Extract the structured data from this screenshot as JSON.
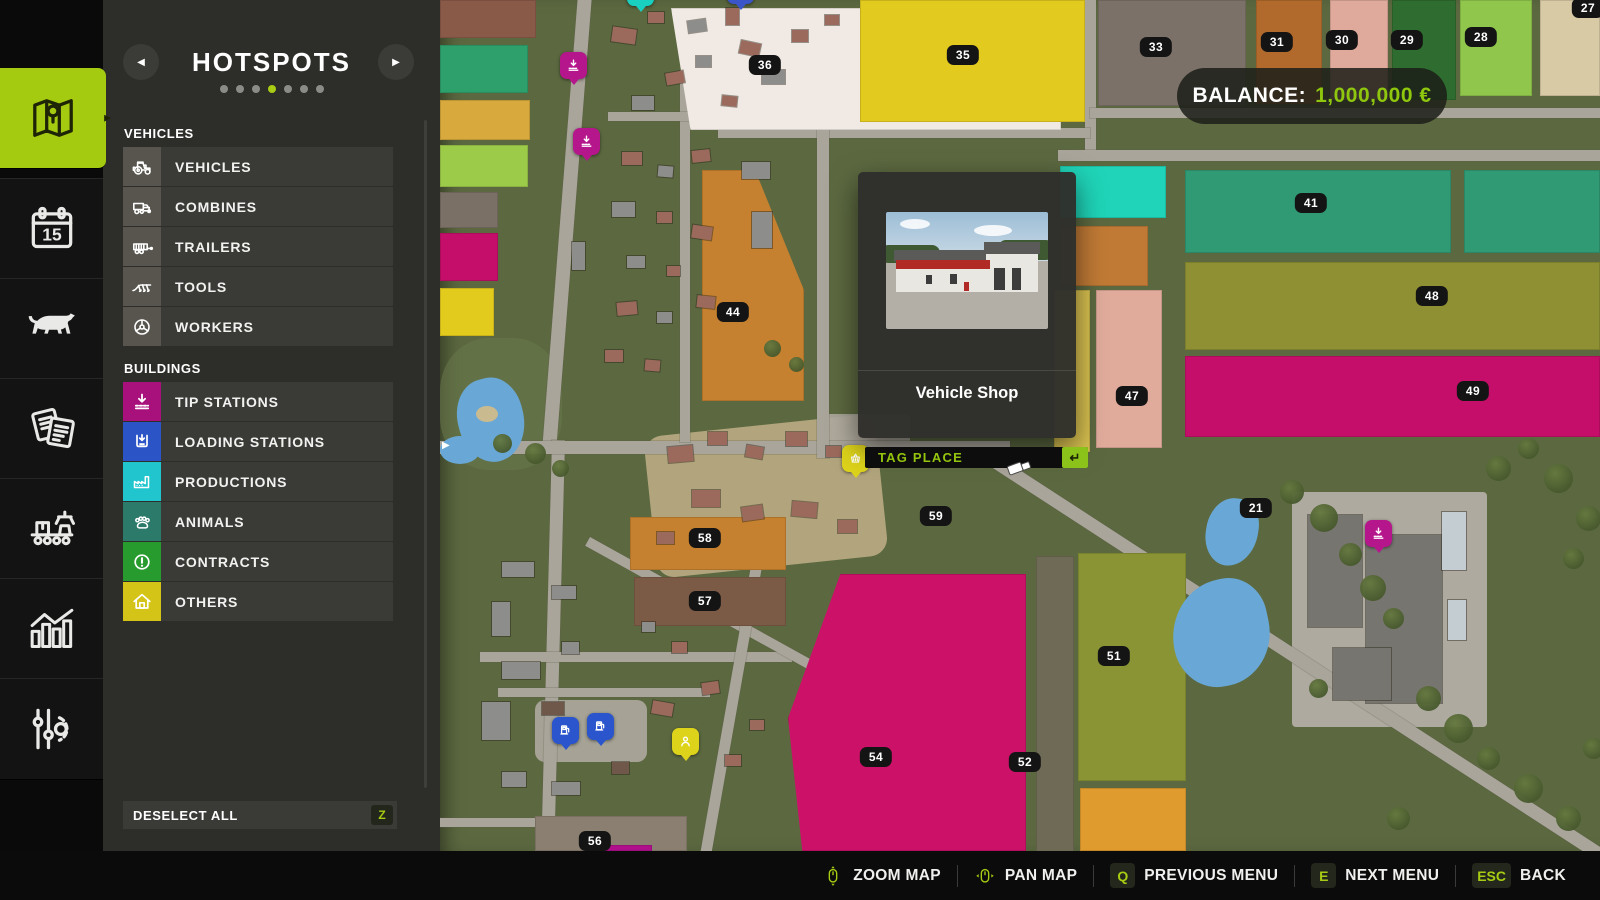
{
  "accent_color": "#a7cc13",
  "sidebar": {
    "tabs": [
      {
        "name": "map",
        "icon": "map-icon",
        "active": true
      },
      {
        "name": "calendar",
        "icon": "calendar-icon",
        "active": false
      },
      {
        "name": "animals",
        "icon": "cow-icon",
        "active": false
      },
      {
        "name": "contracts",
        "icon": "papers-icon",
        "active": false
      },
      {
        "name": "production",
        "icon": "production-icon",
        "active": false
      },
      {
        "name": "statistics",
        "icon": "statistics-icon",
        "active": false
      },
      {
        "name": "settings",
        "icon": "settings-icon",
        "active": false
      }
    ]
  },
  "panel": {
    "title": "HOTSPOTS",
    "dots": {
      "count": 7,
      "active_index": 3
    },
    "sections": [
      {
        "label": "VEHICLES",
        "items": [
          {
            "label": "VEHICLES",
            "icon": "tractor-icon",
            "icon_bg": "#57554e"
          },
          {
            "label": "COMBINES",
            "icon": "combine-icon",
            "icon_bg": "#57554e"
          },
          {
            "label": "TRAILERS",
            "icon": "trailer-icon",
            "icon_bg": "#57554e"
          },
          {
            "label": "TOOLS",
            "icon": "plow-icon",
            "icon_bg": "#57554e"
          },
          {
            "label": "WORKERS",
            "icon": "steering-wheel-icon",
            "icon_bg": "#57554e"
          }
        ]
      },
      {
        "label": "BUILDINGS",
        "items": [
          {
            "label": "TIP STATIONS",
            "icon": "tip-station-icon",
            "icon_bg": "#a8117c"
          },
          {
            "label": "LOADING STATIONS",
            "icon": "loading-station-icon",
            "icon_bg": "#2b54c6"
          },
          {
            "label": "PRODUCTIONS",
            "icon": "factory-icon",
            "icon_bg": "#21c5ce"
          },
          {
            "label": "ANIMALS",
            "icon": "paw-icon",
            "icon_bg": "#2b7a6a"
          },
          {
            "label": "CONTRACTS",
            "icon": "exclamation-icon",
            "icon_bg": "#289b2f"
          },
          {
            "label": "OTHERS",
            "icon": "house-icon",
            "icon_bg": "#d4c417"
          }
        ]
      }
    ],
    "deselect_all": {
      "label": "DESELECT ALL",
      "key": "Z"
    }
  },
  "hud": {
    "balance": {
      "label": "BALANCE:",
      "value": "1,000,000 €",
      "value_color": "#8fc60e"
    },
    "popup": {
      "title": "Vehicle Shop"
    },
    "tag_place": {
      "label": "TAG PLACE",
      "key_glyph": "↵"
    },
    "bottom_bar": [
      {
        "icon": "mouse-zoom-icon",
        "label": "ZOOM MAP"
      },
      {
        "icon": "mouse-pan-icon",
        "label": "PAN MAP"
      },
      {
        "key": "Q",
        "label": "PREVIOUS MENU"
      },
      {
        "key": "E",
        "label": "NEXT MENU"
      },
      {
        "key": "ESC",
        "label": "BACK"
      }
    ]
  },
  "map": {
    "fields": [
      {
        "rect": {
          "x": 231,
          "y": 8,
          "w": 390,
          "h": 122
        },
        "color": "#f1eae4",
        "clip": "polygon(0 0,100% 0,100% 100%,5% 100%)",
        "label": {
          "text": "36",
          "x": 325,
          "y": 65
        }
      },
      {
        "rect": {
          "x": 420,
          "y": 0,
          "w": 225,
          "h": 122
        },
        "color": "#e3ca1e",
        "label": {
          "text": "35",
          "x": 523,
          "y": 55
        }
      },
      {
        "rect": {
          "x": 658,
          "y": 0,
          "w": 148,
          "h": 106
        },
        "color": "#7b7168",
        "label": {
          "text": "33",
          "x": 716,
          "y": 47
        }
      },
      {
        "rect": {
          "x": 816,
          "y": 0,
          "w": 66,
          "h": 104
        },
        "color": "#b16a2c",
        "label": {
          "text": "31",
          "x": 837,
          "y": 42
        }
      },
      {
        "rect": {
          "x": 890,
          "y": 0,
          "w": 58,
          "h": 100
        },
        "color": "#dfa99b",
        "label": {
          "text": "30",
          "x": 902,
          "y": 40
        }
      },
      {
        "rect": {
          "x": 952,
          "y": 0,
          "w": 64,
          "h": 100
        },
        "color": "#2f6c2f",
        "label": {
          "text": "29",
          "x": 967,
          "y": 40
        }
      },
      {
        "rect": {
          "x": 1020,
          "y": 0,
          "w": 72,
          "h": 96
        },
        "color": "#90c64c",
        "label": {
          "text": "28",
          "x": 1041,
          "y": 37
        }
      },
      {
        "rect": {
          "x": 1100,
          "y": 0,
          "w": 60,
          "h": 96
        },
        "color": "#d9caa6",
        "label": {
          "text": "27",
          "x": 1148,
          "y": 8
        }
      },
      {
        "rect": {
          "x": 620,
          "y": 166,
          "w": 106,
          "h": 52
        },
        "color": "#1fd4b8"
      },
      {
        "rect": {
          "x": 745,
          "y": 170,
          "w": 266,
          "h": 83
        },
        "color": "#2f9a74",
        "label": {
          "text": "41",
          "x": 871,
          "y": 203
        }
      },
      {
        "rect": {
          "x": 1024,
          "y": 170,
          "w": 136,
          "h": 83
        },
        "color": "#2f9a74"
      },
      {
        "rect": {
          "x": 620,
          "y": 226,
          "w": 88,
          "h": 60
        },
        "color": "#c07a35"
      },
      {
        "rect": {
          "x": 745,
          "y": 262,
          "w": 415,
          "h": 88
        },
        "color": "#8f9033",
        "label": {
          "text": "48",
          "x": 992,
          "y": 296
        }
      },
      {
        "rect": {
          "x": 745,
          "y": 356,
          "w": 415,
          "h": 81
        },
        "color": "#c50e69",
        "label": {
          "text": "49",
          "x": 1033,
          "y": 391
        }
      },
      {
        "rect": {
          "x": 656,
          "y": 290,
          "w": 66,
          "h": 158
        },
        "color": "#e0ab9b",
        "label": {
          "text": "47",
          "x": 692,
          "y": 396
        }
      },
      {
        "rect": {
          "x": 614,
          "y": 290,
          "w": 36,
          "h": 162
        },
        "color": "#d9c150"
      },
      {
        "rect": {
          "x": 638,
          "y": 553,
          "w": 108,
          "h": 228
        },
        "color": "#8a9434",
        "label": {
          "text": "51",
          "x": 674,
          "y": 656
        }
      },
      {
        "rect": {
          "x": 596,
          "y": 556,
          "w": 38,
          "h": 296
        },
        "color": "#6e6a55",
        "label": {
          "text": "52",
          "x": 585,
          "y": 762
        }
      },
      {
        "rect": {
          "x": 640,
          "y": 788,
          "w": 106,
          "h": 63
        },
        "color": "#e09b2f"
      },
      {
        "rect": {
          "x": 348,
          "y": 574,
          "w": 238,
          "h": 277
        },
        "color": "#cc1168",
        "clip": "polygon(22% 0,100% 0,100% 100%,6% 100%,0 52%)",
        "label": {
          "text": "54",
          "x": 436,
          "y": 757
        }
      },
      {
        "rect": {
          "x": 190,
          "y": 517,
          "w": 156,
          "h": 53
        },
        "color": "#c5812f",
        "label": {
          "text": "58",
          "x": 265,
          "y": 538
        }
      },
      {
        "rect": {
          "x": 194,
          "y": 577,
          "w": 152,
          "h": 49
        },
        "color": "#7b5b45",
        "label": {
          "text": "57",
          "x": 265,
          "y": 601
        }
      },
      {
        "label": {
          "text": "59",
          "x": 496,
          "y": 516
        }
      },
      {
        "rect": {
          "x": 95,
          "y": 816,
          "w": 152,
          "h": 35
        },
        "color": "#8a7f70",
        "label": {
          "text": "56",
          "x": 155,
          "y": 841
        }
      },
      {
        "rect": {
          "x": 262,
          "y": 170,
          "w": 102,
          "h": 231
        },
        "color": "#c5812f",
        "clip": "polygon(0 0,52% 0,100% 52%,100% 100%,0 100%)",
        "label": {
          "text": "44",
          "x": 293,
          "y": 312
        }
      },
      {
        "label": {
          "text": "21",
          "x": 816,
          "y": 508
        }
      },
      {
        "rect": {
          "x": 0,
          "y": 0,
          "w": 96,
          "h": 38
        },
        "color": "#8a5a48"
      },
      {
        "rect": {
          "x": 0,
          "y": 45,
          "w": 88,
          "h": 48
        },
        "color": "#2da06c"
      },
      {
        "rect": {
          "x": 0,
          "y": 100,
          "w": 90,
          "h": 40
        },
        "color": "#d8a93c"
      },
      {
        "rect": {
          "x": 0,
          "y": 145,
          "w": 88,
          "h": 42
        },
        "color": "#9ccb4a"
      },
      {
        "rect": {
          "x": 0,
          "y": 192,
          "w": 58,
          "h": 36
        },
        "color": "#7b7066"
      },
      {
        "rect": {
          "x": 0,
          "y": 233,
          "w": 58,
          "h": 48
        },
        "color": "#c50e69"
      },
      {
        "rect": {
          "x": 0,
          "y": 288,
          "w": 54,
          "h": 48
        },
        "color": "#e3cb1d"
      },
      {
        "rect": {
          "x": 152,
          "y": 845,
          "w": 60,
          "h": 6
        },
        "color": "#b00f8c"
      }
    ],
    "markers": [
      {
        "type": "tip-station",
        "x": 133,
        "y": 65,
        "color": "#b5168c"
      },
      {
        "type": "tip-station",
        "x": 146,
        "y": 141,
        "color": "#b5168c"
      },
      {
        "type": "tip-station",
        "x": 938,
        "y": 533,
        "color": "#b5168c"
      },
      {
        "type": "gas-station",
        "x": 125,
        "y": 730,
        "color": "#2a55cc"
      },
      {
        "type": "gas-station",
        "x": 160,
        "y": 726,
        "color": "#2a55cc"
      },
      {
        "type": "person",
        "x": 245,
        "y": 741,
        "color": "#ddd31b"
      },
      {
        "type": "shop-basket",
        "x": 415,
        "y": 458,
        "color": "#ddd31b"
      },
      {
        "type": "dot",
        "x": 200,
        "y": -8,
        "color": "#19cfc0"
      },
      {
        "type": "dot",
        "x": 300,
        "y": -10,
        "color": "#3a55c8"
      }
    ]
  }
}
